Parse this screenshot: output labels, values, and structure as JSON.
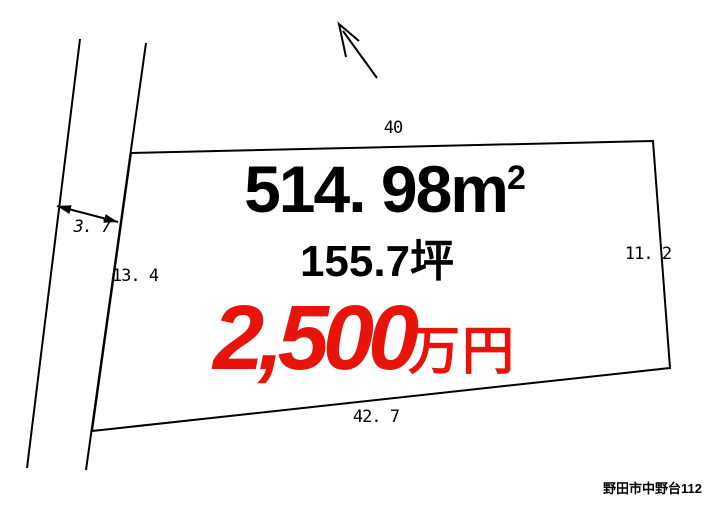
{
  "plot": {
    "area_m2": {
      "value": "514. 98",
      "unit": "m",
      "sup": "2"
    },
    "area_tsubo": "155.7坪",
    "price": {
      "amount": "2,500",
      "unit": "万円"
    },
    "dimensions": {
      "top": "40",
      "right": "11. 2",
      "bottom": "42. 7",
      "left": "13. 4",
      "road_width": "3. 7"
    }
  },
  "address": "野田市中野台112",
  "icons": {
    "north_arrow": "north-arrow-icon"
  },
  "colors": {
    "price_red": "#e8140c",
    "line": "#000000",
    "background": "#ffffff"
  }
}
